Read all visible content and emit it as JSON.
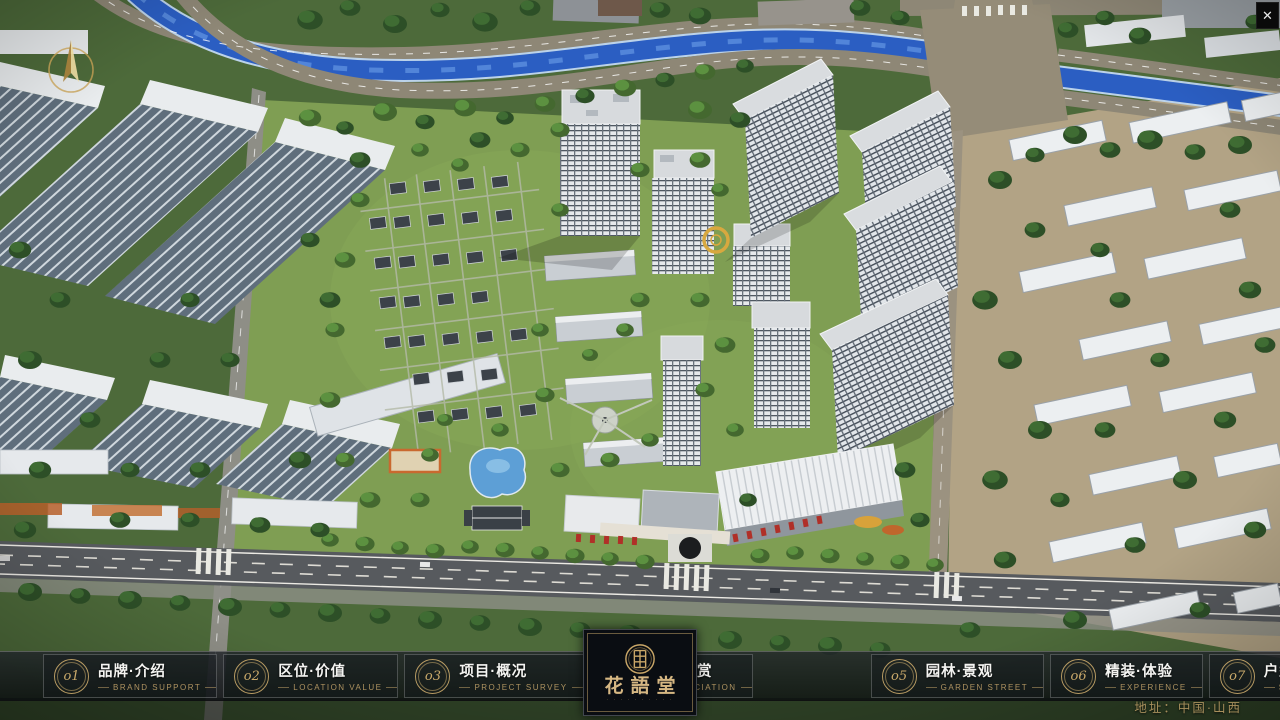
{
  "window": {
    "close_label": "✕"
  },
  "nav": {
    "items": [
      {
        "num": "o1",
        "title": "品牌·介绍",
        "subtitle": "BRAND SUPPORT"
      },
      {
        "num": "o2",
        "title": "区位·价值",
        "subtitle": "LOCATION VALUE"
      },
      {
        "num": "o3",
        "title": "项目·概况",
        "subtitle": "PROJECT SURVEY"
      },
      {
        "num": "o4",
        "title": "建筑·鉴赏",
        "subtitle": "APPRECIATION"
      },
      {
        "num": "o5",
        "title": "园林·景观",
        "subtitle": "GARDEN STREET"
      },
      {
        "num": "o6",
        "title": "精装·体验",
        "subtitle": "EXPERIENCE"
      },
      {
        "num": "o7",
        "title": "户型·分布",
        "subtitle": "SHOW ROOM"
      },
      {
        "num": "o8",
        "title": "一房·一景",
        "subtitle": "COMMUNITY"
      }
    ]
  },
  "logo": {
    "name": "花語堂",
    "tagline": "· · · · · · · · · ·"
  },
  "footer": {
    "address": "地址：中国·山西"
  },
  "colors": {
    "gold": "#c9a96a",
    "nav_bg": "#10151a",
    "river": "#2b5ec2",
    "panel_bg": "#0a0d12"
  }
}
